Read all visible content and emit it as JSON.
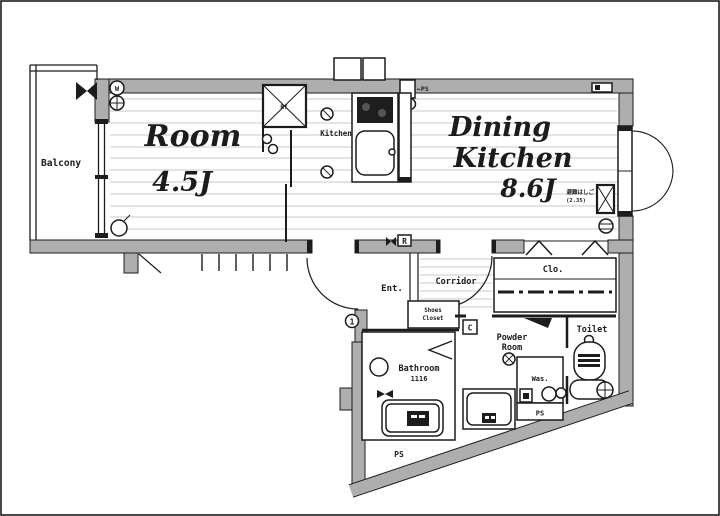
{
  "plan": {
    "colors": {
      "wall_fill": "#aeaeae",
      "line": "#1c1c1c",
      "floor_line": "#c9c9c9"
    },
    "balcony": {
      "label": "Balcony"
    },
    "room": {
      "name": "Room",
      "size": "4.5J"
    },
    "dining_kitchen": {
      "name_line1": "Dining",
      "name_line2": "Kitchen",
      "size": "8.6J",
      "escape_ladder_label": "避難はしご",
      "escape_ladder_size": "(2.35)"
    },
    "kitchen": {
      "label": "Kitchen",
      "fridge_label": "Rf",
      "pipe_space_label": "←PS",
      "meter_label": "M"
    },
    "entrance": {
      "label": "Ent.",
      "door_number": "1",
      "r_mark": "R"
    },
    "corridor": {
      "label": "Corridor"
    },
    "shoes_closet": {
      "line1": "Shoes",
      "line2": "Closet",
      "c_mark": "C"
    },
    "closet": {
      "label": "Clo."
    },
    "powder_room": {
      "line1": "Powder",
      "line2": "Room",
      "washer_label": "Was.",
      "ps_label": "PS"
    },
    "toilet": {
      "label": "Toilet"
    },
    "bathroom": {
      "label": "Bathroom",
      "size": "1116",
      "ps_label": "PS"
    },
    "symbols": {
      "w_circle": "W"
    }
  }
}
